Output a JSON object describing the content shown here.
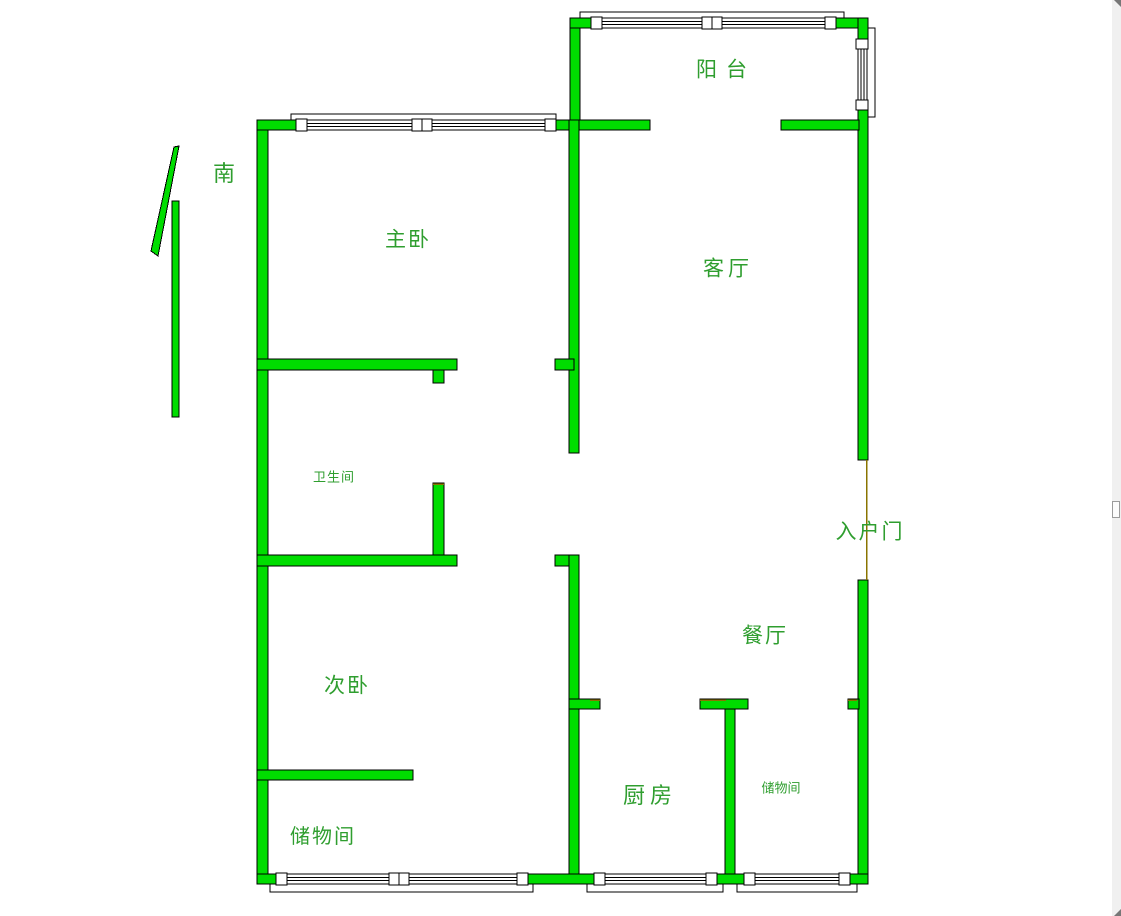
{
  "title": "户型图",
  "colors": {
    "wall_fill": "#00dd00",
    "wall_outline": "#000000",
    "window_fill": "#ffffff",
    "label_color": "#2f9e2f",
    "door_line": "#8a7400",
    "scrollbar_track": "#f0f0f0",
    "scrollbar_thumb": "#fbfbfb",
    "scrollbar_thumb_border": "#9a9a9a",
    "scrollbar_arrow": "#777777"
  },
  "compass": {
    "direction_label": "南"
  },
  "rooms": {
    "balcony": "阳台",
    "master_bedroom": "主卧",
    "living_room": "客厅",
    "bathroom": "卫生间",
    "second_bedroom": "次卧",
    "storage_west": "储物间",
    "kitchen": "厨房",
    "storage_middle": "储物间",
    "dining_room": "餐厅",
    "entrance_door": "入户门"
  }
}
